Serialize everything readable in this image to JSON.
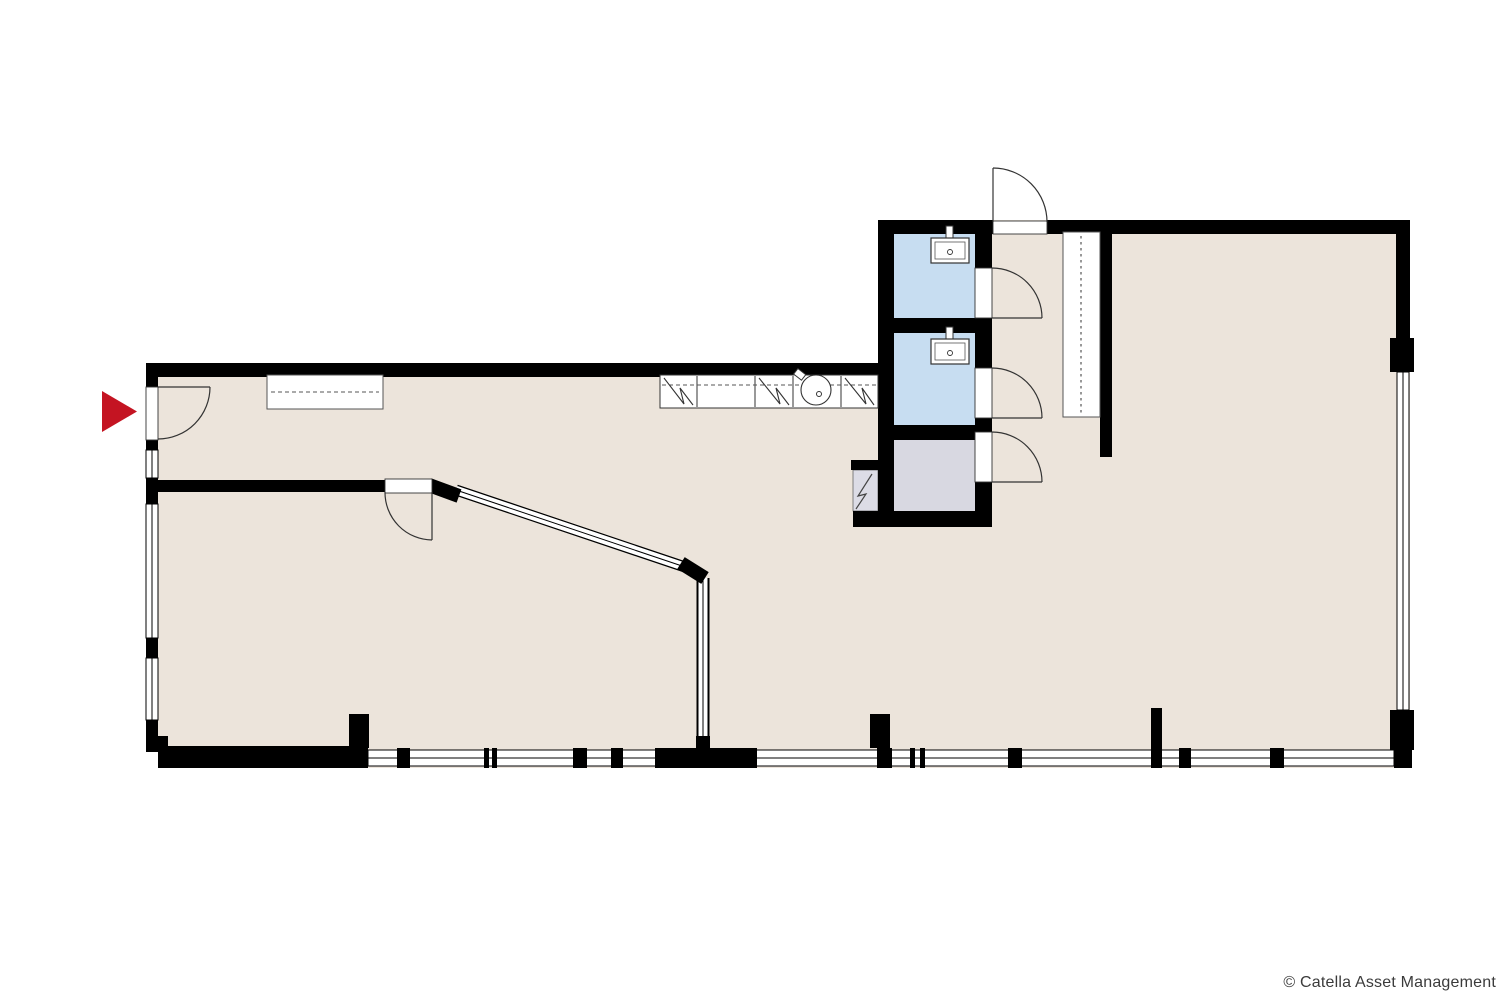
{
  "page": {
    "background": "#ffffff",
    "copyright": "© Catella Asset Management"
  },
  "floorplan": {
    "colors": {
      "wall": "#000000",
      "floor": "#ece4db",
      "wet_room": "#c7ddf1",
      "storage_room": "#d8d8e1",
      "shaft": "#dcdce6",
      "entrance_arrow": "#c41422",
      "glazing_line": "#000000",
      "fixture_outline": "#333333",
      "furniture_outline": "#555555",
      "copyright_text": "#3b3b3b"
    }
  }
}
